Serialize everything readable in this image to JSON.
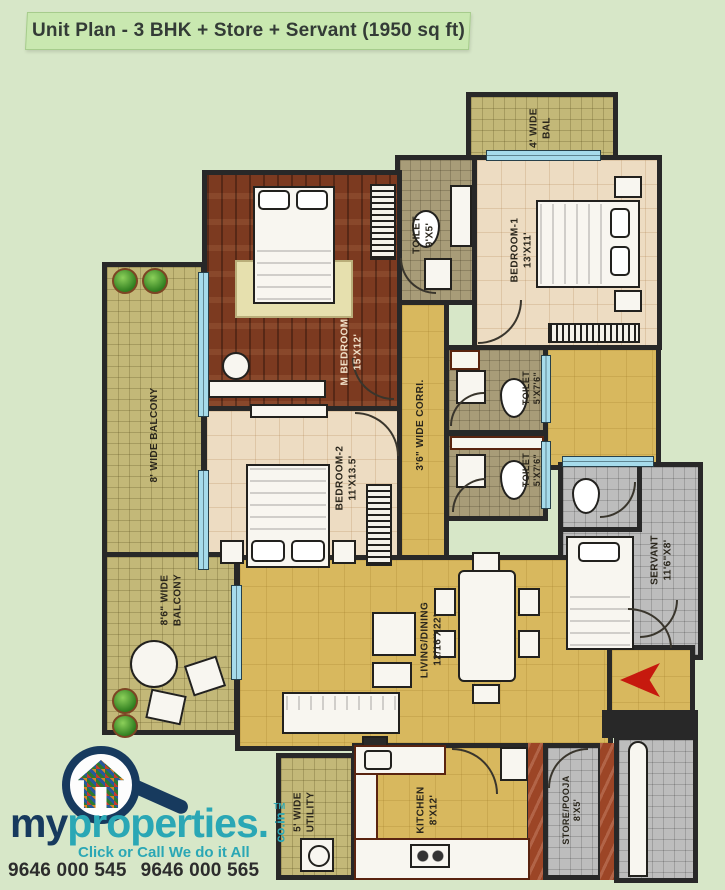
{
  "banner": {
    "title": "Unit Plan - 3 BHK + Store + Servant (1950 sq ft)"
  },
  "rooms": {
    "balcony_top": {
      "line1": "4' WIDE",
      "line2": "BAL"
    },
    "toilet_top": {
      "line1": "TOILET",
      "line2": "9'X5'"
    },
    "bedroom1": {
      "line1": "BEDROOM-1",
      "line2": "13'X11'"
    },
    "m_bedroom": {
      "line1": "M BEDROOM",
      "line2": "15'X12'"
    },
    "balcony_left": {
      "line1": "8' WIDE BALCONY"
    },
    "bedroom2": {
      "line1": "BEDROOM-2",
      "line2": "11'X13.5'"
    },
    "corridor": {
      "line1": "3'6\" WIDE CORRI."
    },
    "toilet_mid1": {
      "line1": "TOILET",
      "line2": "5'X7'6\""
    },
    "toilet_mid2": {
      "line1": "TOILET",
      "line2": "5'X7'6\""
    },
    "balcony_lower": {
      "line1": "8'6\" WIDE",
      "line2": "BALCONY"
    },
    "living": {
      "line1": "LIVING/DINING",
      "line2": "12/16'X22'"
    },
    "servant": {
      "line1": "SERVANT",
      "line2": "11'6\"X8'"
    },
    "utility": {
      "line1": "5' WIDE",
      "line2": "UTILITY"
    },
    "kitchen": {
      "line1": "KITCHEN",
      "line2": "8'X12'"
    },
    "store": {
      "line1": "STORE/POOJA",
      "line2": "8'X5'"
    }
  },
  "logo": {
    "brand_my": "my",
    "brand_properties": "properties",
    "brand_dot": ".",
    "brand_domain": "co.in",
    "trademark": "TM",
    "tagline": "Click or Call We do it All",
    "phone1": "9646 000 545",
    "phone2": "9646 000 565"
  },
  "colors": {
    "page_bg": "#d7e7c8",
    "banner_bg": "#c9e8b0",
    "wall": "#282828",
    "wood_floor": "#7c3a20",
    "mustard_floor": "#d8b85e",
    "olive_tile": "#c3b878",
    "cream_tile": "#eddcc2",
    "toilet_tile": "#a89c78",
    "grey_tile": "#bdbdbd",
    "marble_red": "#9c4526",
    "window_blue": "#a6dbeb",
    "entry_arrow_red": "#c6190e",
    "brand_navy": "#173a5e",
    "brand_teal": "#2aa7b5"
  }
}
